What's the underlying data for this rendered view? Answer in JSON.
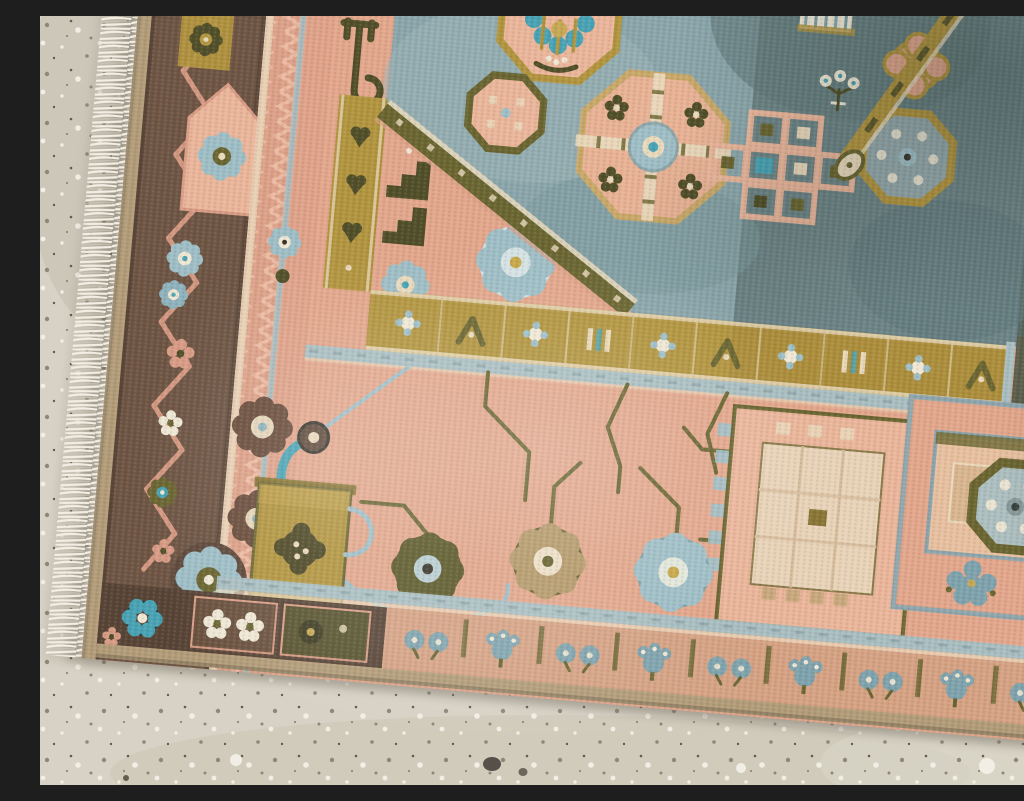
{
  "scene": {
    "type": "photograph",
    "subject": "Corner of a faded vintage hand-knotted rug on a speckled concrete floor",
    "description": "Close-up photograph of the lower-left corner of a faded vintage hand-knotted rug laid on a gray speckled concrete floor. The rug sits at a slight clockwise tilt. A white warp fringe runs along its left edge, followed by a chocolate-brown guard border with a salmon zigzag vine and small blossoms. The main field is salmon-peach; its upper panel is slate blue with octagonal gul medallions, a stepped square lattice, and a diagonal gold ribbon, separated from the lower field by an ochre-gold band filled with blossom and chevron cells. The lower field carries olive vines, eight-petal rosettes in brown, olive, tan and powder blue, a teal-spouted ewer, a large cream square tile and a blue-framed square tile. The bottom border shows brown panels with cream blossoms and a teal rosette at the corner, then a salmon band of paired blue blossoms and palmettes between olive bars.",
    "floor": {
      "material": "speckled concrete / terrazzo",
      "visible_edges": [
        "left",
        "bottom"
      ],
      "details": [
        "dark pebble lower center",
        "white stone chips",
        "fine gray-brown speckle"
      ]
    },
    "rug": {
      "orientation_deg_clockwise": 5,
      "fringe": {
        "side": "left",
        "color_ref": "fringe_white"
      },
      "outer_border": {
        "ground_color_ref": "border_brown",
        "motifs": [
          "salmon zigzag vine",
          "cream cross blossoms",
          "powder-blue rosette pair",
          "gold square with olive rosette",
          "pentagon house with blue rosette"
        ]
      },
      "bottom_border": {
        "left_section": "dark brown panels with cream blossoms, olive panel, teal rosette at corner",
        "right_section": "salmon band with pairs of blue blossoms and blue palmettes separated by olive bars"
      },
      "field": {
        "ground_color_ref": "field_peach",
        "upper_panel": "slate blue, darker toward the right corner",
        "divider": "ochre gold band with blossom, chevron and bar cells plus a vertical and a diagonal branch",
        "motifs": [
          "octagonal gul with teal fan flower cut by top edge",
          "small olive-ringed octagon",
          "large peach octagon medallion with cream cross bars and teal-dot ring center",
          "peach quatrefoil on dark blue ground",
          "stepped square lattice motif with olive and teal cells",
          "gold-ringed octagon rosette",
          "diagonal gold ribbon with eye pendant",
          "pin-striped cream block",
          "white bud sprig",
          "powder-blue eight-petal rosette",
          "dark stepped totem",
          "brown eight-petal rosettes",
          "olive rosette",
          "tan rosette",
          "powder-blue rosette",
          "teal-spouted ewer with gold body",
          "large cream square tile with checker edge",
          "blue-framed square tile with blossom cluster",
          "olive octagon daisy"
        ]
      }
    },
    "palette": {
      "floor_base": "#d7d2c5",
      "floor_shade": "#c3bdaf",
      "floor_speck_dark": "#8f8878",
      "floor_speck_darker": "#645d4f",
      "floor_speck_light": "#f1eee5",
      "rug_shadow": "#6f675a",
      "fringe_white": "#f2eee3",
      "binding_tan": "#b29c79",
      "border_brown": "#6f5645",
      "border_brown_dark": "#584537",
      "vine_salmon": "#d89c85",
      "guard_salmon": "#dca188",
      "guard_cream": "#e8cfb3",
      "field_peach": "#e2a78c",
      "peach_light": "#eab69b",
      "peach_deep": "#d6997f",
      "cream": "#e9d9bc",
      "cream_white": "#efe7d4",
      "gold": "#b29540",
      "gold_light": "#c6a855",
      "olive": "#6b6632",
      "olive_dark": "#52502a",
      "slate_blue": "#8ba6ab",
      "slate_blue_dark": "#6d8486",
      "dark_corner": "#57665e",
      "pale_blue": "#a9bec1",
      "powder_blue": "#9fbec6",
      "blue_gray": "#7fa3ad",
      "teal": "#4aa3b4",
      "rosette_brown": "#6b4e3d",
      "tan_petal": "#b59a6b",
      "dark_accent": "#3a362c"
    }
  }
}
